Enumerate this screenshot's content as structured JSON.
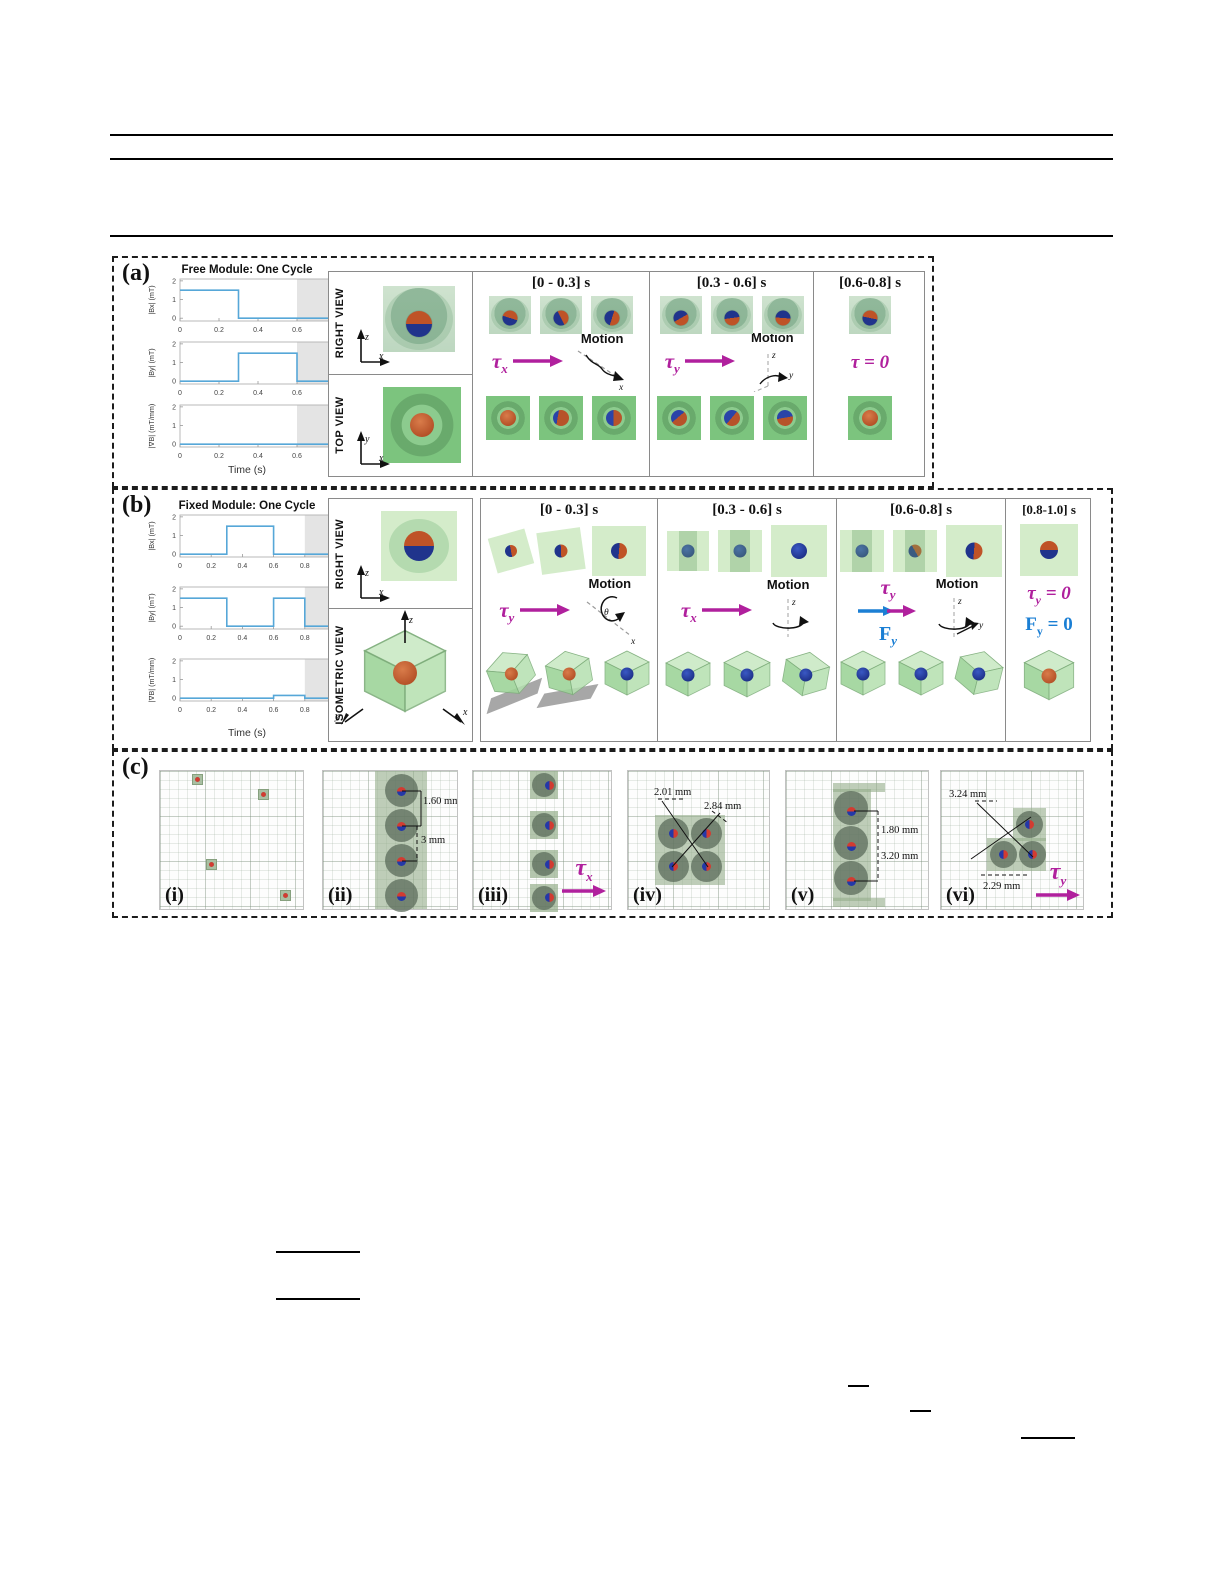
{
  "panel_a": {
    "label": "(a)",
    "chart": {
      "type": "line",
      "title": "Free Module: One Cycle",
      "xlabel": "Time (s)",
      "xlim": [
        0,
        0.8
      ],
      "xticks": [
        0,
        0.2,
        0.4,
        0.6,
        0.8
      ],
      "ylim": [
        -0.15,
        2.1
      ],
      "yticks": [
        0,
        1,
        2
      ],
      "shade": [
        0.6,
        0.8
      ],
      "line_color": "#56a7d8",
      "subplots": [
        {
          "ylabel": "|Bx| (mT)",
          "x": [
            0,
            0.3,
            0.3,
            0.8
          ],
          "y": [
            1.5,
            1.5,
            0,
            0
          ]
        },
        {
          "ylabel": "|By| (mT)",
          "x": [
            0,
            0.3,
            0.3,
            0.6,
            0.6,
            0.8
          ],
          "y": [
            0,
            0,
            1.5,
            1.5,
            0,
            0
          ]
        },
        {
          "ylabel": "|∇B| (mT/mm)",
          "x": [
            0,
            0.8
          ],
          "y": [
            0,
            0
          ]
        }
      ]
    },
    "views": [
      {
        "label": "RIGHT VIEW",
        "vaxis": "z",
        "haxis": "x"
      },
      {
        "label": "TOP VIEW",
        "vaxis": "y",
        "haxis": "x"
      }
    ],
    "columns": [
      {
        "header": "[0 - 0.3] s",
        "tau_sym": "τ",
        "tau_sub": "x",
        "motion": "Motion",
        "axis1": "x",
        "axis2": ""
      },
      {
        "header": "[0.3 - 0.6] s",
        "tau_sym": "τ",
        "tau_sub": "y",
        "motion": "Motion",
        "axis1": "z",
        "axis2": "y"
      },
      {
        "header": "[0.6-0.8] s",
        "tau_eq": "τ = 0"
      }
    ]
  },
  "panel_b": {
    "label": "(b)",
    "chart": {
      "type": "line",
      "title": "Fixed Module: One Cycle",
      "xlabel": "Time (s)",
      "xlim": [
        0,
        1
      ],
      "xticks": [
        0,
        0.2,
        0.4,
        0.6,
        0.8,
        1
      ],
      "ylim": [
        -0.15,
        2.1
      ],
      "yticks": [
        0,
        1,
        2
      ],
      "shade": [
        0.8,
        1
      ],
      "line_color": "#56a7d8",
      "subplots": [
        {
          "ylabel": "|Bx| (mT)",
          "x": [
            0,
            0.3,
            0.3,
            0.6,
            0.6,
            1
          ],
          "y": [
            0,
            0,
            1.5,
            1.5,
            0,
            0
          ]
        },
        {
          "ylabel": "|By| (mT)",
          "x": [
            0,
            0.3,
            0.3,
            0.6,
            0.6,
            0.8,
            0.8,
            1
          ],
          "y": [
            1.5,
            1.5,
            0,
            0,
            1.5,
            1.5,
            0,
            0
          ]
        },
        {
          "ylabel": "|∇B| (mT/mm)",
          "x": [
            0,
            0.6,
            0.6,
            0.8,
            0.8,
            1
          ],
          "y": [
            0,
            0,
            0.15,
            0.15,
            0,
            0
          ]
        }
      ]
    },
    "views": [
      {
        "label": "RIGHT VIEW",
        "vaxis": "z",
        "haxis": "x"
      },
      {
        "label": "ISOMETRIC VIEW",
        "up": "z",
        "left": "y",
        "right": "x"
      }
    ],
    "columns": [
      {
        "header": "[0 - 0.3] s",
        "tau_sym": "τ",
        "tau_sub": "y",
        "motion": "Motion",
        "axis1": "θ",
        "axis2": "x"
      },
      {
        "header": "[0.3 - 0.6] s",
        "tau_sym": "τ",
        "tau_sub": "x",
        "motion": "Motion",
        "axis1": "z",
        "axis2": ""
      },
      {
        "header": "[0.6-0.8] s",
        "tau_sym": "τ",
        "tau_sub": "y",
        "force_sym": "F",
        "force_sub": "y",
        "motion": "Motion",
        "axis1": "z",
        "axis2": "y"
      },
      {
        "header": "[0.8-1.0] s",
        "tau_sym": "τ",
        "tau_sub": "y",
        "tau_eq": " = 0",
        "force_sym": "F",
        "force_sub": "y",
        "force_eq": " = 0"
      }
    ]
  },
  "panel_c": {
    "label": "(c)",
    "items": [
      {
        "label": "(i)"
      },
      {
        "label": "(ii)",
        "dim1": "1.60 mm",
        "dim2": "3 mm"
      },
      {
        "label": "(iii)",
        "tau_sym": "τ",
        "tau_sub": "x"
      },
      {
        "label": "(iv)",
        "dim1": "2.01 mm",
        "dim2": "2.84 mm"
      },
      {
        "label": "(v)",
        "dim1": "1.80 mm",
        "dim2": "3.20 mm"
      },
      {
        "label": "(vi)",
        "dim1": "3.24 mm",
        "dim2": "2.29 mm",
        "tau_sym": "τ",
        "tau_sub": "y"
      }
    ]
  },
  "colors": {
    "torque": "#b0209d",
    "force": "#1b7fd4",
    "plot_line": "#56a7d8",
    "plot_shade": "#e4e4e4",
    "module_green": "#7cc47e",
    "pale_green": "#d4ecca",
    "sphere_orange": "#bf5327",
    "sphere_blue": "#20348c"
  }
}
